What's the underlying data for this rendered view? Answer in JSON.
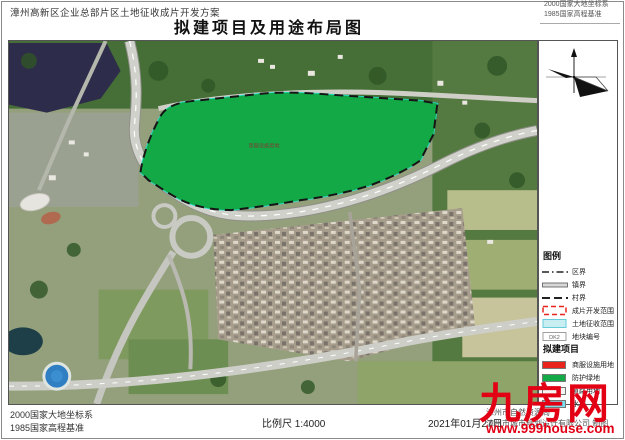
{
  "header": {
    "project_label": "漳州高新区企业总部片区土地征收成片开发方案",
    "title": "拟建项目及用途布局图"
  },
  "datum": {
    "line1": "2000国家大地坐标系",
    "line2": "1985国家高程基准"
  },
  "map": {
    "plot_label": "商服设施用地"
  },
  "legend": {
    "title": "图例",
    "items": [
      {
        "label": "区界"
      },
      {
        "label": "镇界"
      },
      {
        "label": "村界"
      },
      {
        "label": "成片开发范围"
      },
      {
        "label": "土地征收范围"
      },
      {
        "label": "地块编号",
        "symbol_text": "DK2"
      }
    ],
    "projects_title": "拟建项目",
    "projects": [
      {
        "label": "商服设施用地",
        "color": "#e8241c"
      },
      {
        "label": "防护绿地",
        "color": "#12a946"
      },
      {
        "label": "道路用地",
        "color": "#f4f4f0"
      },
      {
        "label": "水域",
        "color": "#79e2ee"
      }
    ]
  },
  "footer": {
    "scale": "比例尺 1:4000",
    "date": "2021年01月27日",
    "credit_line1": "漳州市自然资源局",
    "credit_line2": "漳州市城市规划设计有限公司 制图"
  },
  "watermark": {
    "text": "九房网",
    "url": "www.999house.com",
    "color": "#e30015"
  }
}
